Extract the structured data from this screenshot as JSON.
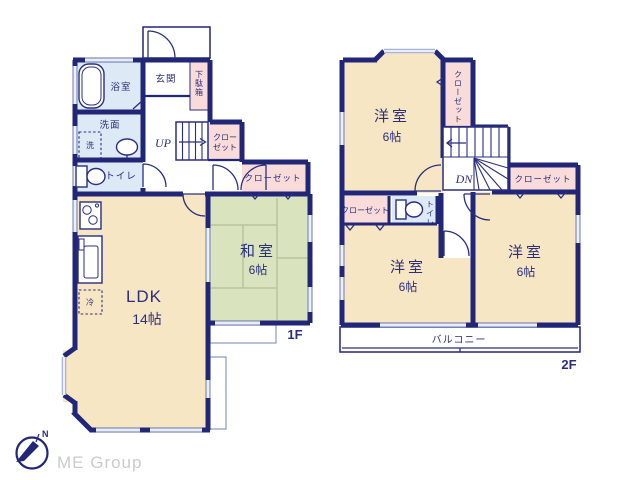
{
  "colors": {
    "wall": "#222677",
    "ink": "#2a2f7d",
    "cream": "#f7e6c4",
    "green": "#d9e4bf",
    "blue": "#dde9f5",
    "pink": "#f9dcd9",
    "win": "#a9b5d8",
    "thin": "#8d96bf",
    "tatami": "#b9c49c",
    "gray": "#cbcbcb"
  },
  "floor1": {
    "floor_label": "1F",
    "ldk": {
      "name": "LDK",
      "size": "14帖"
    },
    "washitsu": {
      "name": "和室",
      "size": "6帖"
    },
    "genkan": "玄関",
    "getabako": "下駄箱",
    "bath": "浴室",
    "washroom": "洗面",
    "laundry": "洗",
    "toilet": "トイレ",
    "fridge": "冷",
    "stairs": "UP",
    "closet_hall": {
      "line1": "クロー",
      "line2": "ゼット"
    },
    "closet_wide": "クローゼット"
  },
  "floor2": {
    "floor_label": "2F",
    "bedroom_top": {
      "name": "洋室",
      "size": "6帖"
    },
    "bedroom_mid": {
      "name": "洋室",
      "size": "6帖"
    },
    "bedroom_right": {
      "name": "洋室",
      "size": "6帖"
    },
    "closet_top": "クローゼット",
    "closet_right": "クローゼット",
    "closet_left": "クローゼット",
    "toilet": "トイレ",
    "stairs": "DN",
    "balcony": "バルコニー"
  },
  "logo": {
    "north": "N",
    "company": "ME Group"
  }
}
